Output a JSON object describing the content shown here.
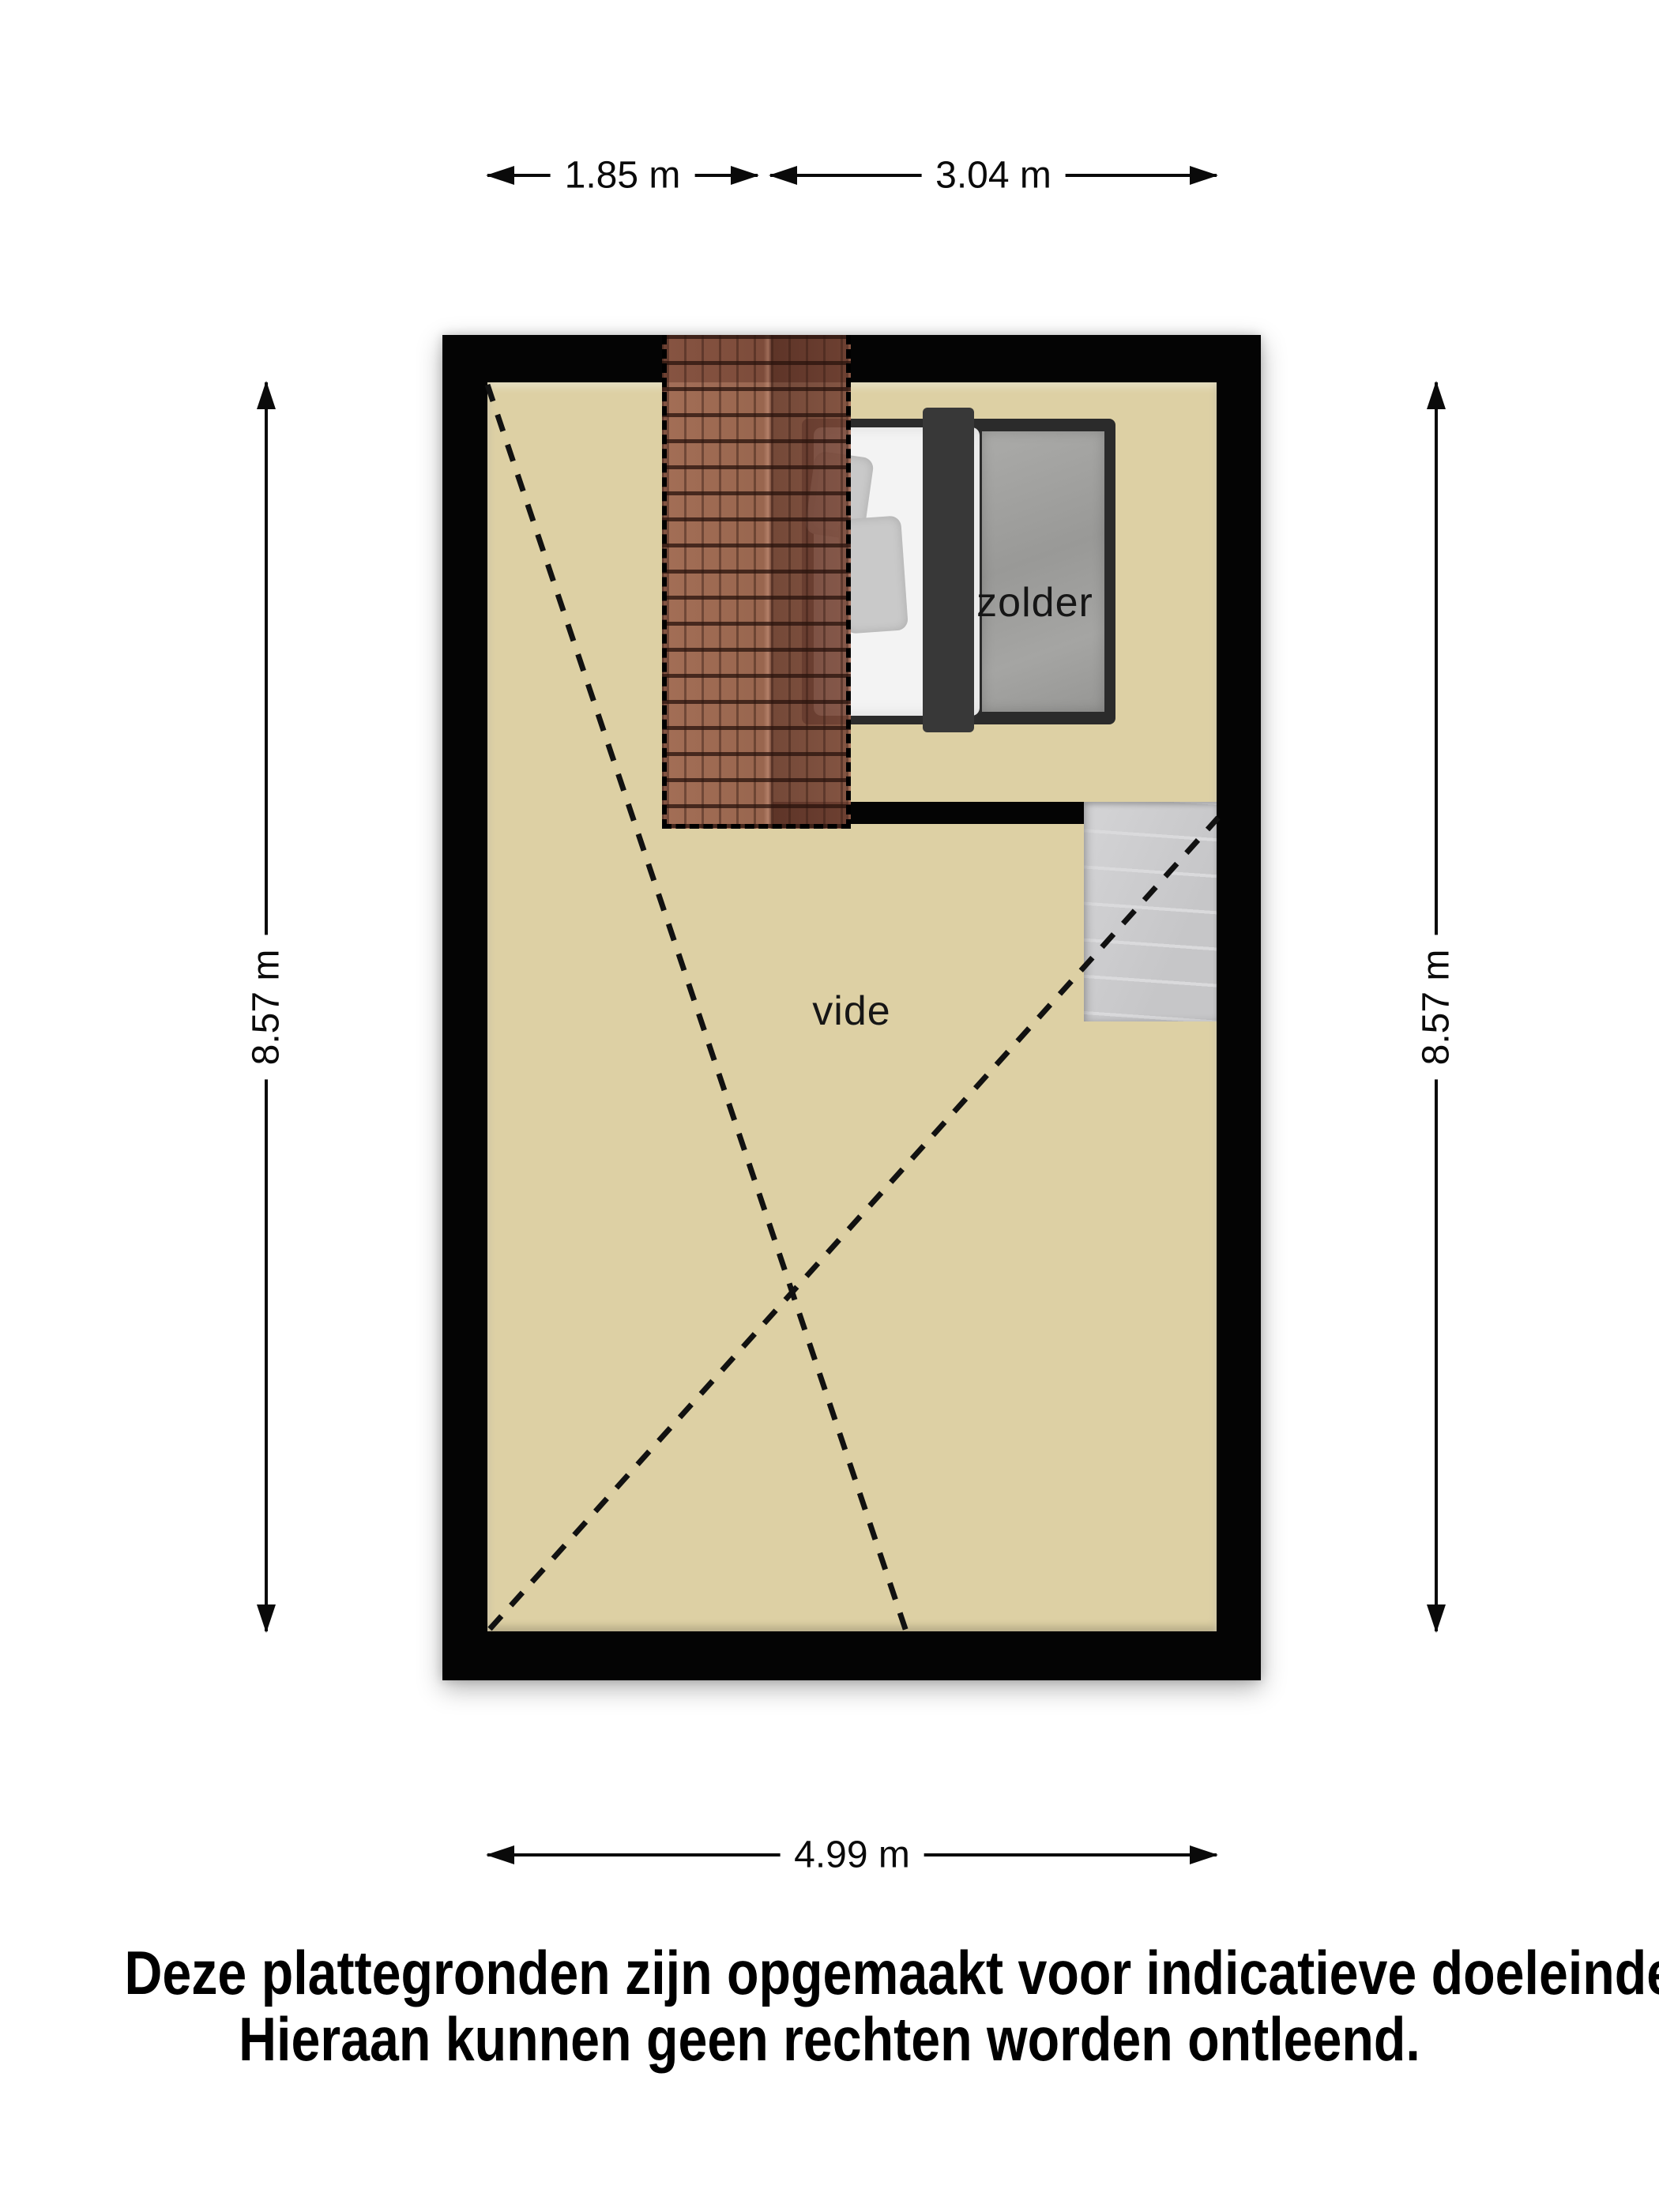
{
  "floorplan": {
    "rooms": [
      {
        "name": "zolder"
      },
      {
        "name": "vide"
      }
    ],
    "furniture": [
      {
        "name": "bed"
      },
      {
        "name": "staircase"
      },
      {
        "name": "roof-overlay"
      }
    ],
    "colors": {
      "floor": "#DDD0A4",
      "wall": "#040404",
      "roof_tile": "#8F5A46",
      "stairs": "#CDCDCF",
      "bed_frame": "#2B2B2B",
      "bed_duvet": "#9E9E9C",
      "bed_mattress": "#F3F3F3",
      "bed_pillow": "#C9C9C9",
      "dash_line": "#111111"
    }
  },
  "dimensions": {
    "top_left": {
      "label": "1.85 m"
    },
    "top_right": {
      "label": "3.04 m"
    },
    "left": {
      "label": "8.57 m"
    },
    "right": {
      "label": "8.57 m"
    },
    "bottom": {
      "label": "4.99 m"
    }
  },
  "disclaimer": {
    "line1": "Deze plattegronden zijn opgemaakt voor indicatieve doeleinden.",
    "line2": "Hieraan kunnen geen rechten worden ontleend."
  }
}
